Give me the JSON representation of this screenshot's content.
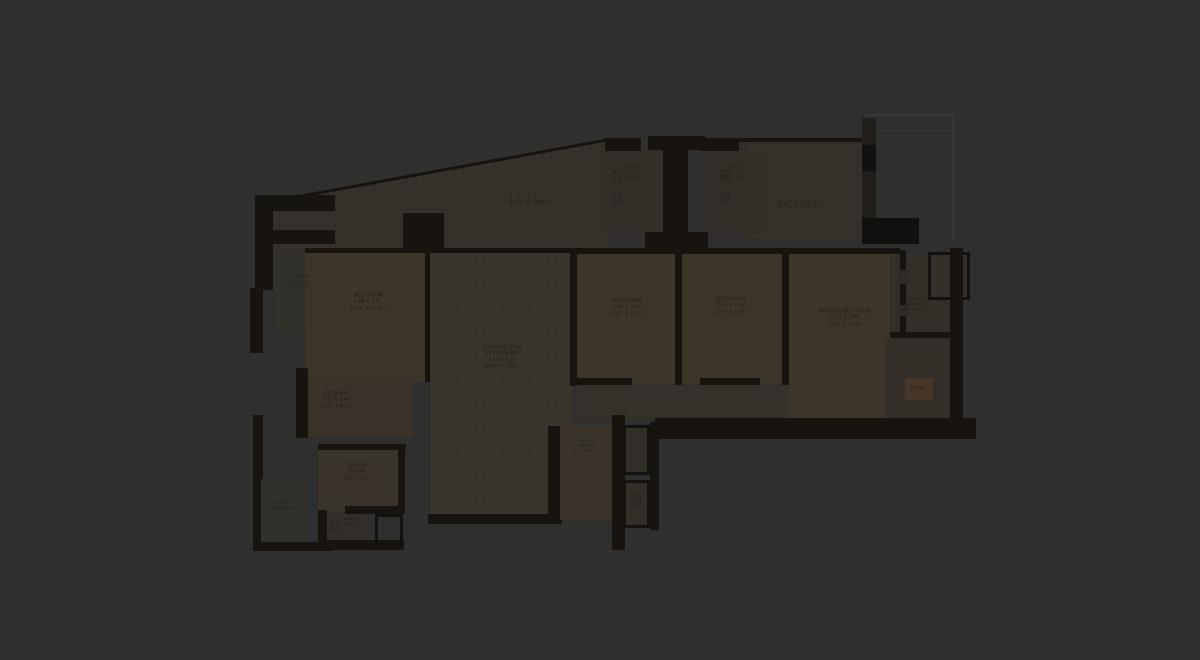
{
  "page": {
    "description": "Dimmed architectural floor plan on dark background",
    "colors": {
      "background": "#2f2f2f",
      "wall": "#17140f",
      "room_fill": "#3d352a",
      "deck_fill": "#36322b",
      "wood_fill": "#453627",
      "label_text": "#201c17"
    }
  },
  "labels": {
    "balcony_left": "BALCONY",
    "balcony_right": "BALCONY",
    "toilet_tl": {
      "l1": "TOILET",
      "l2": "1.2 X 2.1",
      "l3": "(4'0\" X 7'0\")"
    },
    "toilet_a": {
      "l1": "TOILET",
      "l2": "1.5 X 2.4",
      "l3": "(5'0\" X 8'0\")"
    },
    "toilet_b": {
      "l1": "TOILET",
      "l2": "1.5 X 2.4",
      "l3": "(5'0\" X 8'0\")"
    },
    "bedroom1": {
      "l1": "BED ROOM",
      "l2": "3.86 X 3.51",
      "l3": "(12'8\" X 11'6\")"
    },
    "drawing": {
      "l1": "DRAWING CUM",
      "l2": "DINING AREA",
      "l3": "7.16 X 4.72",
      "l4": "(23'6\" X 15'6\")"
    },
    "bedroom2": {
      "l1": "BED ROOM",
      "l2": "3.66 X 3.35",
      "l3": "(12'0\" X 11'0\")"
    },
    "bedroom3": {
      "l1": "BED ROOM",
      "l2": "3.66 X 3.35",
      "l3": "(12'0\" X 11'0\")"
    },
    "master": {
      "l1": "MASTER BED ROOM",
      "l2": "4.27 X 3.96",
      "l3": "(14'0\" X 13'0\")"
    },
    "toilet_r": {
      "l1": "TOILET",
      "l2": "1.5 X 2.6",
      "l3": "(5'0\" X 8'6\")"
    },
    "dress": "DRESS",
    "kitchen": {
      "l1": "KITCHEN",
      "l2": "3.35 X 2.44",
      "l3": "(11'0\" X 8'0\")"
    },
    "maid": {
      "l1": "MAID'S",
      "l2": "ROOM",
      "l3": "(8'0\" X 7'6\")"
    },
    "utility": {
      "l1": "UTILITY",
      "l2": "BALCONY"
    },
    "foyer": {
      "l1": "ENTRANCE",
      "l2": "FOYER",
      "l3": "(6'0\" X 10'0\")"
    },
    "maid_toilet": {
      "l1": "MAID'S",
      "l2": "TOILET"
    }
  }
}
